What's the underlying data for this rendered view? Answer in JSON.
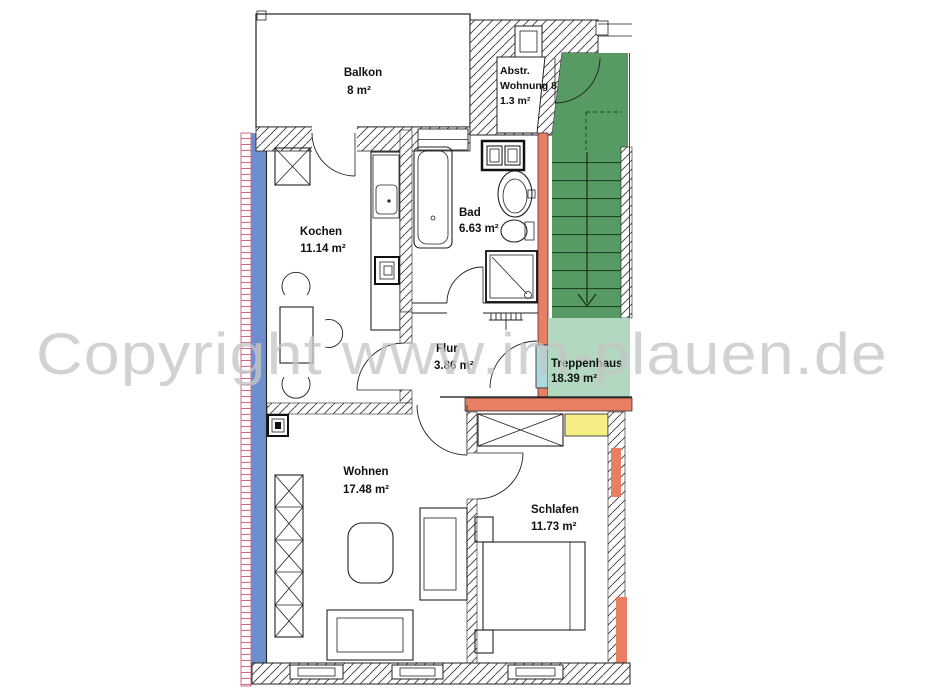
{
  "watermark": "Copyright www.im-plauen.de",
  "rooms": {
    "balkon": {
      "name": "Balkon",
      "area": "8 m²"
    },
    "abstellraum": {
      "line1": "Abstr.",
      "line2": "Wohnung 8",
      "line3": "1.3 m²"
    },
    "kochen": {
      "name": "Kochen",
      "area": "11.14 m²"
    },
    "bad": {
      "name": "Bad",
      "area": "6.63 m²"
    },
    "flur": {
      "name": "Flur",
      "area": "3.86 m²"
    },
    "treppenhaus": {
      "name": "Treppenhaus",
      "area": "18.39 m²"
    },
    "wohnen": {
      "name": "Wohnen",
      "area": "17.48 m²"
    },
    "schlafen": {
      "name": "Schlafen",
      "area": "11.73 m²"
    }
  },
  "colors": {
    "stairs_green": "#579a63",
    "hall_green": "#b2d8c0",
    "wall_salmon": "#e87f62",
    "exterior_blue": "#6e8fcd",
    "window_yellow": "#f5ee85",
    "door_teal": "#aedade",
    "hatch_pink": "#c85a78",
    "watermark_gray": "#c6c6c6",
    "hatch_line": "#3a3a3a"
  }
}
